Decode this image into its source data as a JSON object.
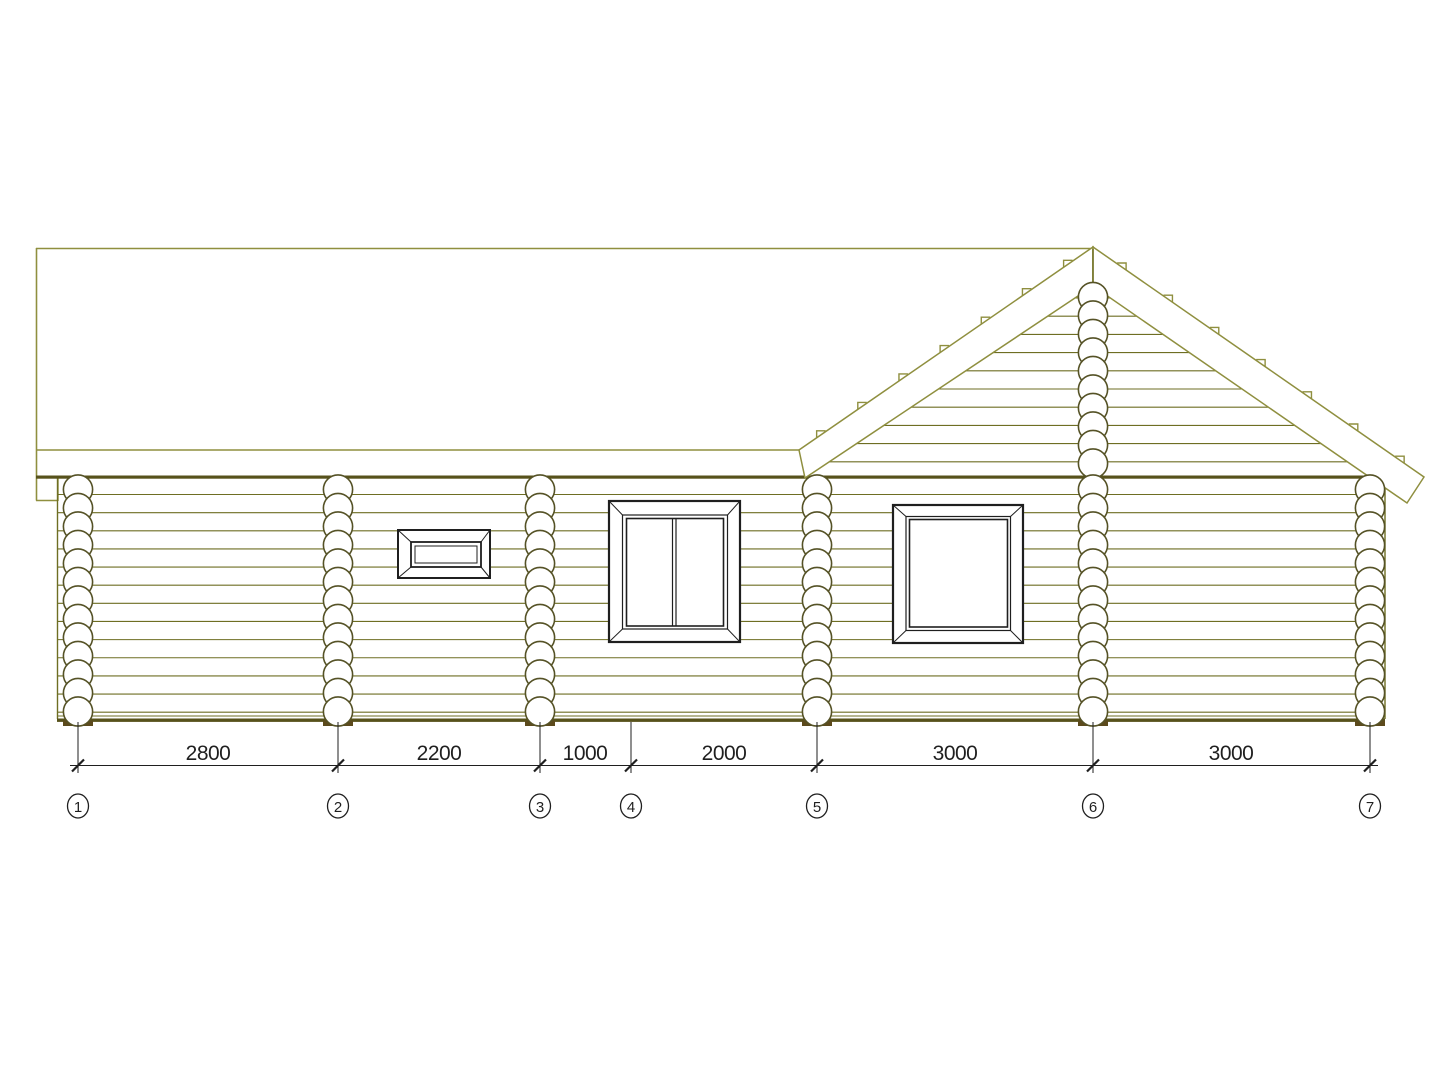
{
  "dimensions": {
    "values": [
      "2800",
      "2200",
      "1000",
      "2000",
      "3000",
      "3000"
    ]
  },
  "axes": {
    "labels": [
      "1",
      "2",
      "3",
      "4",
      "5",
      "6",
      "7"
    ]
  },
  "colors": {
    "background": "#ffffff",
    "roof_line": "#8f8f3f",
    "log_line": "#6e6e23",
    "dark_line": "#57521b",
    "log_end_outline": "#555226",
    "foundation_pad": "#5c4a1c",
    "ink": "#1f1f1f"
  }
}
